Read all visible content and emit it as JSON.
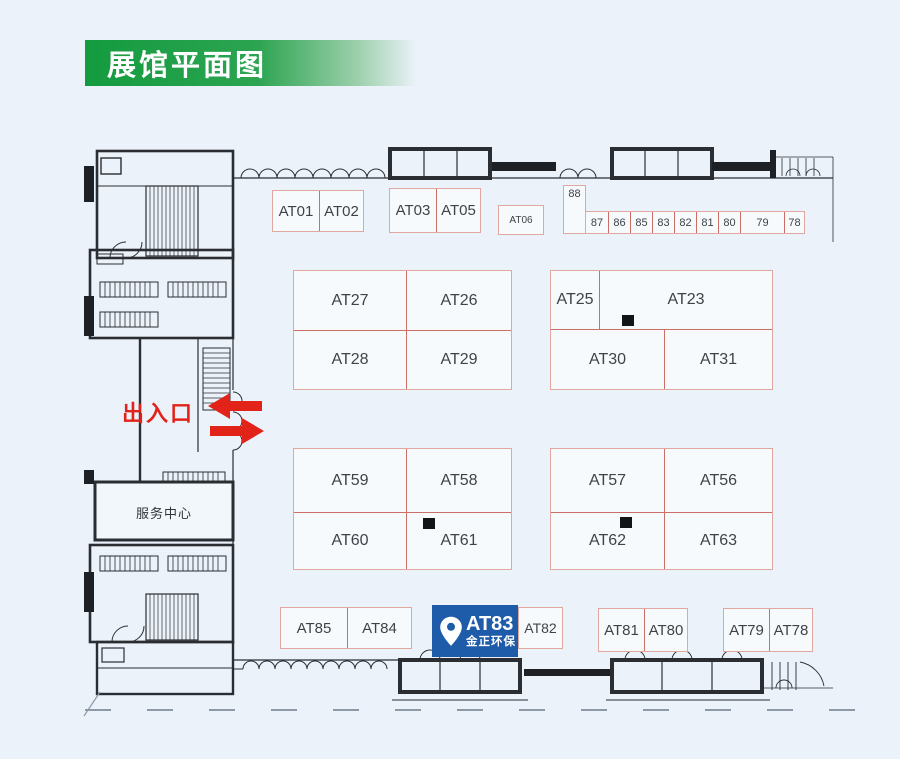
{
  "header": {
    "title": "展馆平面图"
  },
  "labels": {
    "entrance": "出入口",
    "service_center": "服务中心"
  },
  "highlight": {
    "booth": "AT83",
    "company": "金正环保",
    "color": "#1e5ba8",
    "pin_icon": "location-pin"
  },
  "colors": {
    "background": "#ecf2fa",
    "header_green": "#2ca451",
    "booth_border": "#e0a79f",
    "booth_divider": "#cb6f66",
    "booth_fill": "#f7fafd",
    "booth_text": "#3f4348",
    "accent_red": "#e2231a",
    "highlight_blue": "#1e5ba8",
    "wall_black": "#2a2e33"
  },
  "blocks": [
    {
      "name": "top-a",
      "x": 272,
      "y": 190,
      "w": 92,
      "h": 42,
      "fs": 15,
      "rows": [
        {
          "cells": [
            {
              "label": "AT01",
              "w": 46
            },
            {
              "label": "AT02"
            }
          ]
        }
      ]
    },
    {
      "name": "top-b",
      "x": 389,
      "y": 188,
      "w": 92,
      "h": 45,
      "fs": 15,
      "rows": [
        {
          "cells": [
            {
              "label": "AT03",
              "w": 46
            },
            {
              "label": "AT05"
            }
          ]
        }
      ]
    },
    {
      "name": "top-c",
      "x": 498,
      "y": 205,
      "w": 46,
      "h": 30,
      "fs": 10,
      "rows": [
        {
          "cells": [
            {
              "label": "AT06"
            }
          ]
        }
      ]
    },
    {
      "name": "booth-88",
      "x": 563,
      "y": 185,
      "w": 23,
      "h": 49,
      "fs": 11,
      "rows": [
        {
          "cells": [
            {
              "label": "88",
              "top": true
            }
          ]
        }
      ]
    },
    {
      "name": "strip-87-78",
      "x": 585,
      "y": 211,
      "w": 220,
      "h": 23,
      "fs": 11,
      "rows": [
        {
          "cells": [
            {
              "label": "87",
              "w": 22
            },
            {
              "label": "86",
              "w": 22
            },
            {
              "label": "85",
              "w": 22
            },
            {
              "label": "83",
              "w": 22
            },
            {
              "label": "82",
              "w": 22
            },
            {
              "label": "81",
              "w": 22
            },
            {
              "label": "80",
              "w": 22
            },
            {
              "label": "79",
              "w": 44
            },
            {
              "label": "78"
            }
          ]
        }
      ]
    },
    {
      "name": "mid-left",
      "x": 293,
      "y": 270,
      "w": 219,
      "h": 120,
      "fs": 16,
      "rows": [
        {
          "h": 59,
          "cells": [
            {
              "label": "AT27",
              "w": 112
            },
            {
              "label": "AT26"
            }
          ]
        },
        {
          "cells": [
            {
              "label": "AT28",
              "w": 112
            },
            {
              "label": "AT29"
            }
          ]
        }
      ]
    },
    {
      "name": "mid-right",
      "x": 550,
      "y": 270,
      "w": 223,
      "h": 120,
      "fs": 16,
      "rows": [
        {
          "h": 58,
          "cells": [
            {
              "label": "AT25",
              "w": 48
            },
            {
              "label": "AT23",
              "marker": [
                22,
                44
              ]
            }
          ]
        },
        {
          "cells": [
            {
              "label": "AT30",
              "w": 113
            },
            {
              "label": "AT31"
            }
          ]
        }
      ]
    },
    {
      "name": "low-left",
      "x": 293,
      "y": 448,
      "w": 219,
      "h": 122,
      "fs": 16,
      "rows": [
        {
          "h": 63,
          "cells": [
            {
              "label": "AT59",
              "w": 112
            },
            {
              "label": "AT58"
            }
          ]
        },
        {
          "cells": [
            {
              "label": "AT60",
              "w": 112
            },
            {
              "label": "AT61",
              "marker": [
                16,
                5
              ]
            }
          ]
        }
      ]
    },
    {
      "name": "low-right",
      "x": 550,
      "y": 448,
      "w": 223,
      "h": 122,
      "fs": 16,
      "rows": [
        {
          "h": 63,
          "cells": [
            {
              "label": "AT57",
              "w": 113
            },
            {
              "label": "AT56"
            }
          ]
        },
        {
          "cells": [
            {
              "label": "AT62",
              "w": 113,
              "marker": [
                69,
                4
              ]
            },
            {
              "label": "AT63"
            }
          ]
        }
      ]
    },
    {
      "name": "bottom-a",
      "x": 280,
      "y": 607,
      "w": 132,
      "h": 42,
      "fs": 15,
      "rows": [
        {
          "cells": [
            {
              "label": "AT85",
              "w": 66
            },
            {
              "label": "AT84"
            }
          ]
        }
      ]
    },
    {
      "name": "bottom-82",
      "x": 518,
      "y": 607,
      "w": 45,
      "h": 42,
      "fs": 14,
      "rows": [
        {
          "cells": [
            {
              "label": "AT82"
            }
          ]
        }
      ]
    },
    {
      "name": "bottom-b",
      "x": 598,
      "y": 608,
      "w": 90,
      "h": 44,
      "fs": 15,
      "rows": [
        {
          "cells": [
            {
              "label": "AT81",
              "w": 45
            },
            {
              "label": "AT80"
            }
          ]
        }
      ]
    },
    {
      "name": "bottom-c",
      "x": 723,
      "y": 608,
      "w": 90,
      "h": 44,
      "fs": 15,
      "rows": [
        {
          "cells": [
            {
              "label": "AT79",
              "w": 45
            },
            {
              "label": "AT78"
            }
          ]
        }
      ]
    }
  ]
}
